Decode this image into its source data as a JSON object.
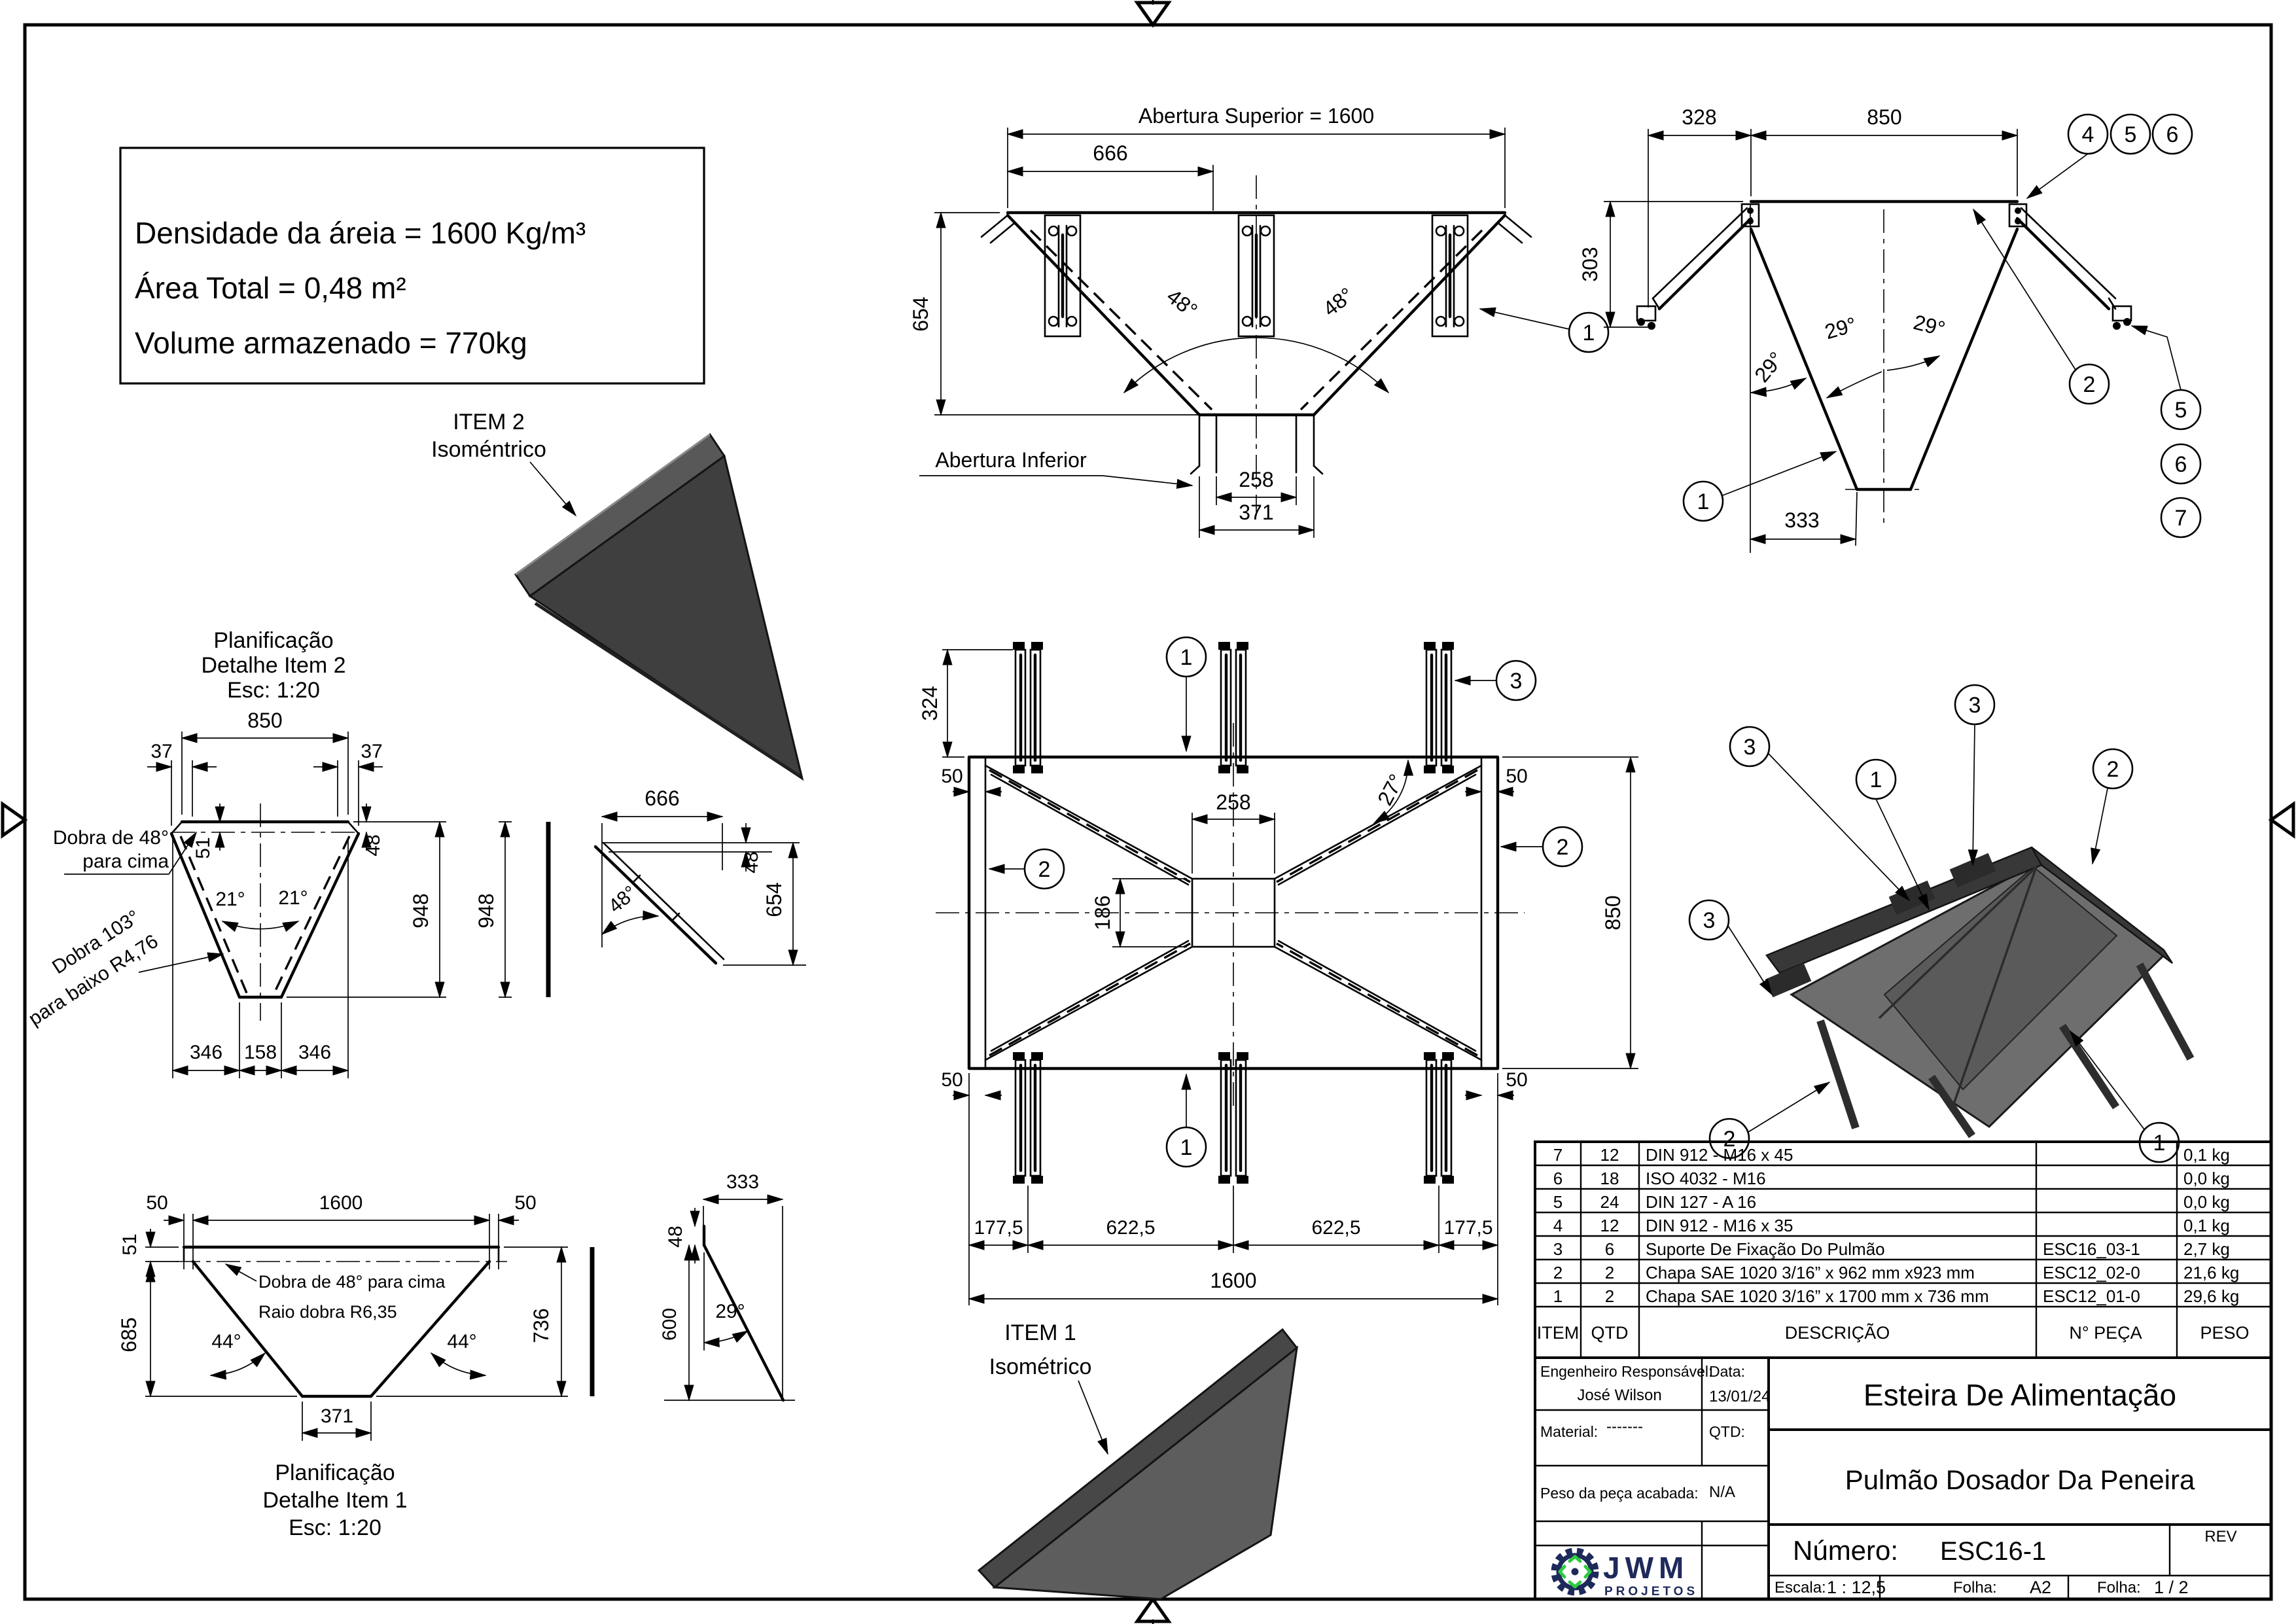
{
  "info_box": {
    "line1": "Densidade da áreia = 1600 Kg/m³",
    "line2": "Área Total = 0,48 m²",
    "line3": "Volume armazenado = 770kg"
  },
  "front_view": {
    "dim_top": "Abertura Superior = 1600",
    "dim_666": "666",
    "dim_654": "654",
    "angle_left": "48°",
    "angle_right": "48°",
    "label_bottom": "Abertura Inferior",
    "dim_258": "258",
    "dim_371": "371",
    "balloon": "1"
  },
  "side_view": {
    "dim_328": "328",
    "dim_850": "850",
    "dim_303": "303",
    "dim_333": "333",
    "angles": [
      "29°",
      "29°",
      "29°"
    ],
    "balloons_top": [
      "4",
      "5",
      "6"
    ],
    "balloon_left": "1",
    "balloon_right": "2",
    "balloons_chain": [
      "5",
      "6",
      "7"
    ]
  },
  "plan_view": {
    "dim_324": "324",
    "dim_50_tl": "50",
    "dim_50_tr": "50",
    "dim_50_bl": "50",
    "dim_50_br": "50",
    "dim_258": "258",
    "dim_186": "186",
    "angle_27": "27°",
    "dim_850": "850",
    "dims_bottom": [
      "177,5",
      "622,5",
      "622,5",
      "177,5"
    ],
    "dim_1600": "1600",
    "balloon_top": "1",
    "balloon_top_right": "3",
    "balloon_left": "2",
    "balloon_right": "2",
    "balloon_bottom": "1"
  },
  "flat_item2": {
    "title": [
      "Planificação",
      "Detalhe Item 2",
      "Esc: 1:20"
    ],
    "dim_850": "850",
    "dim_37_l": "37",
    "dim_37_r": "37",
    "dim_51": "51",
    "dim_48": "48",
    "dim_948_a": "948",
    "dim_948_b": "948",
    "angle_l": "21°",
    "angle_r": "21°",
    "dims_bottom": [
      "346",
      "158",
      "346"
    ],
    "note_up": [
      "Dobra de 48°",
      "para cima"
    ],
    "note_down": [
      "Dobra 103°",
      "para baixo R4,76"
    ]
  },
  "profile_item2": {
    "dim_666": "666",
    "dim_48": "48",
    "dim_654": "654",
    "angle": "48°"
  },
  "flat_item1": {
    "title": [
      "Planificação",
      "Detalhe Item 1",
      "Esc: 1:20"
    ],
    "dim_50_l": "50",
    "dim_1600": "1600",
    "dim_50_r": "50",
    "dim_51": "51",
    "dim_685": "685",
    "dim_736": "736",
    "angle_l": "44°",
    "angle_r": "44°",
    "dim_371": "371",
    "note": [
      "Dobra de 48° para cima",
      "Raio dobra R6,35"
    ]
  },
  "profile_item1": {
    "dim_333": "333",
    "dim_48": "48",
    "dim_600": "600",
    "angle": "29°"
  },
  "iso_item2": {
    "label": [
      "ITEM 2",
      "Isoméntrico"
    ]
  },
  "iso_item1": {
    "label": [
      "ITEM 1",
      "Isométrico"
    ]
  },
  "iso_assembly": {
    "balloons": [
      "3",
      "3",
      "1",
      "2",
      "3",
      "2",
      "1"
    ]
  },
  "bom": {
    "headers": [
      "ITEM",
      "QTD",
      "DESCRIÇÃO",
      "N° PEÇA",
      "PESO"
    ],
    "rows": [
      [
        "7",
        "12",
        "DIN 912 - M16 x 45",
        "",
        "0,1 kg"
      ],
      [
        "6",
        "18",
        "ISO 4032 - M16",
        "",
        "0,0 kg"
      ],
      [
        "5",
        "24",
        "DIN 127 - A 16",
        "",
        "0,0 kg"
      ],
      [
        "4",
        "12",
        "DIN 912 - M16 x 35",
        "",
        "0,1 kg"
      ],
      [
        "3",
        "6",
        "Suporte De Fixação Do Pulmão",
        "ESC16_03-1",
        "2,7 kg"
      ],
      [
        "2",
        "2",
        "Chapa SAE 1020 3/16” x 962 mm x923 mm",
        "ESC12_02-0",
        "21,6 kg"
      ],
      [
        "1",
        "2",
        "Chapa SAE 1020 3/16” x 1700 mm x 736 mm",
        "ESC12_01-0",
        "29,6 kg"
      ]
    ]
  },
  "title_block": {
    "engineer_label": "Engenheiro Responsável:",
    "engineer_name": "José Wilson",
    "date_label": "Data:",
    "date_value": "13/01/24",
    "material_label": "Material:",
    "material_value": "-------",
    "qtd_label": "QTD:",
    "weight_label": "Peso da peça acabada:",
    "weight_value": "N/A",
    "project_title": "Esteira De Alimentação",
    "part_title": "Pulmão Dosador Da Peneira",
    "number_label": "Número:",
    "number_value": "ESC16-1",
    "rev_label": "REV",
    "scale_label": "Escala:",
    "scale_value": "1 : 12,5",
    "sheet_size_label": "Folha:",
    "sheet_size_value": "A2",
    "sheet_num_label": "Folha:",
    "sheet_num_value": "1 / 2"
  },
  "logo": {
    "name": "JWM",
    "subtitle": "PROJETOS"
  },
  "colors": {
    "line": "#000000",
    "iso_dark": "#3f3f3f",
    "iso_mid": "#5d5d5d",
    "iso_light": "#6e6e6e",
    "logo_navy": "#1e2a5a",
    "logo_green": "#2ecc40"
  }
}
